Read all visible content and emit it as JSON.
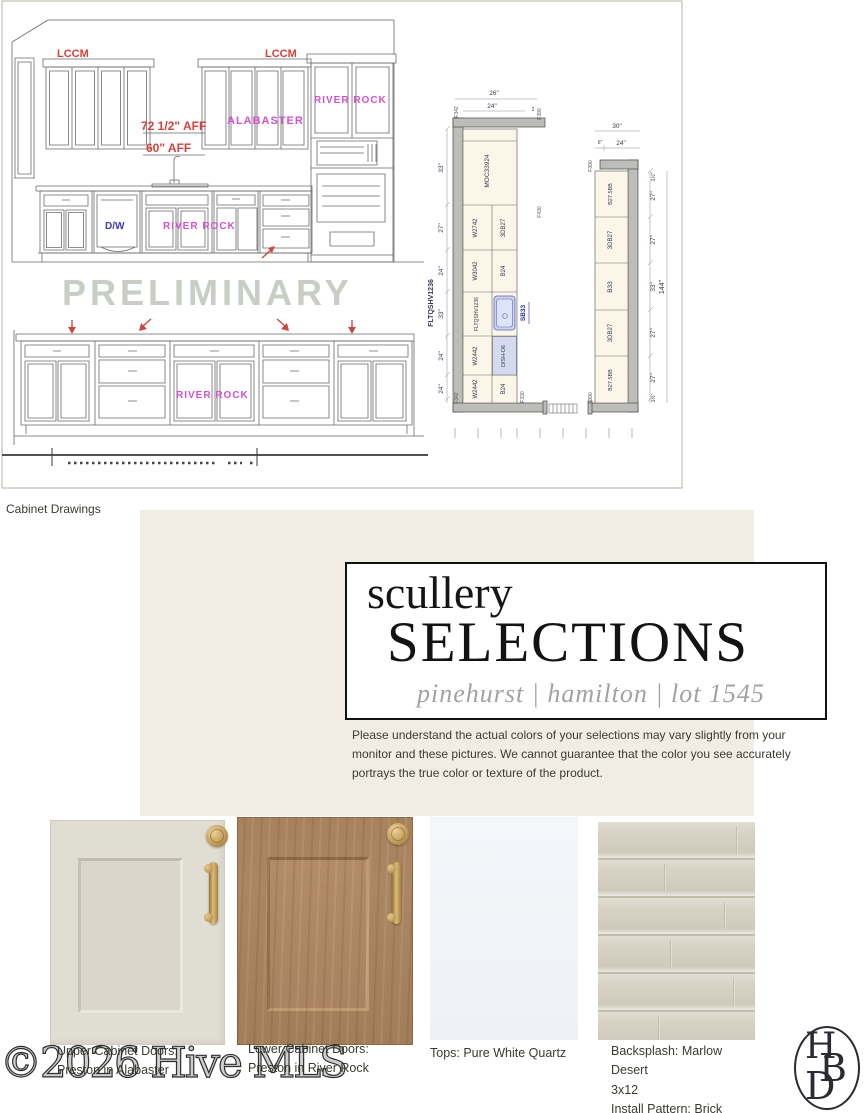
{
  "drawing": {
    "caption": "Cabinet Drawings",
    "preliminary": "PRELIMINARY",
    "upper_elevation": {
      "lccm_left": "LCCM",
      "lccm_right": "LCCM",
      "river_rock_upper": "RIVER ROCK",
      "alabaster": "ALABASTER",
      "aff_72": "72 1/2\" AFF",
      "aff_60": "60\" AFF",
      "dw": "D/W",
      "river_rock_base": "RIVER ROCK"
    },
    "lower_elevation": {
      "river_rock": "RIVER ROCK"
    },
    "plan": {
      "moc": "MOC33924",
      "wall_col": [
        "W2742",
        "W3042",
        "FLTQSHV1236",
        "W2442",
        "W2442"
      ],
      "base_col": [
        "3DB27",
        "B24",
        "DISH-D6",
        "B24"
      ],
      "sink": "SB33",
      "outer_label": "FLTQSHV1236",
      "right_col": [
        "B27.5BB",
        "3DB27",
        "B33",
        "3DB27",
        "B27.5BB"
      ],
      "dims": {
        "top_outer": "26\"",
        "top_inner": "24\"",
        "top_small": "2",
        "left": [
          "33\"",
          "27\"",
          "24\"",
          "33\"",
          "24\"",
          "24\""
        ],
        "right_top_outer": "30\"",
        "right_top_small": "6\"",
        "right_top_inner": "24\"",
        "right": [
          "1½\"",
          "27\"",
          "27\"",
          "33\"",
          "27\"",
          "27\"",
          "1½\""
        ],
        "total": "144\""
      },
      "tags": {
        "f342a": "F342",
        "f390a": "F390",
        "f430": "F430",
        "f342b": "F342",
        "f330": "F330",
        "f390b": "F390",
        "f390c": "F390"
      }
    }
  },
  "selections": {
    "title_small": "scullery",
    "title_large": "SELECTIONS",
    "subtitle": "pinehurst | hamilton | lot 1545",
    "disclaimer": "Please understand the actual colors of your selections may vary slightly from your monitor and these pictures. We cannot guarantee that the color you see accurately portrays the true color or texture of the product.",
    "samples": [
      {
        "line1": "Upper Cabinet Doors:",
        "line2": "Preston in Alabaster",
        "line3": ""
      },
      {
        "line1": "Lower Cabinet Doors:",
        "line2": "Preston in River Rock",
        "line3": ""
      },
      {
        "line1": "Tops: Pure White Quartz",
        "line2": "",
        "line3": ""
      },
      {
        "line1": "Backsplash: Marlow Desert",
        "line2": "3x12",
        "line3": "Install Pattern: Brick"
      }
    ],
    "colors": {
      "panel_beige": "#f1ede5",
      "alabaster": "#e0ddd2",
      "river_rock": "#a8825c",
      "quartz": "#f4f6fa",
      "tile": "#d8d2c4",
      "brass": "#c49e5b",
      "label_red": "#d8403a",
      "label_magenta": "#cf52cf",
      "label_blue": "#3c3cb4"
    }
  },
  "footer": {
    "mls_watermark": "©2026 Hive MLS",
    "logo": {
      "h": "H",
      "b": "B",
      "d": "D"
    }
  }
}
